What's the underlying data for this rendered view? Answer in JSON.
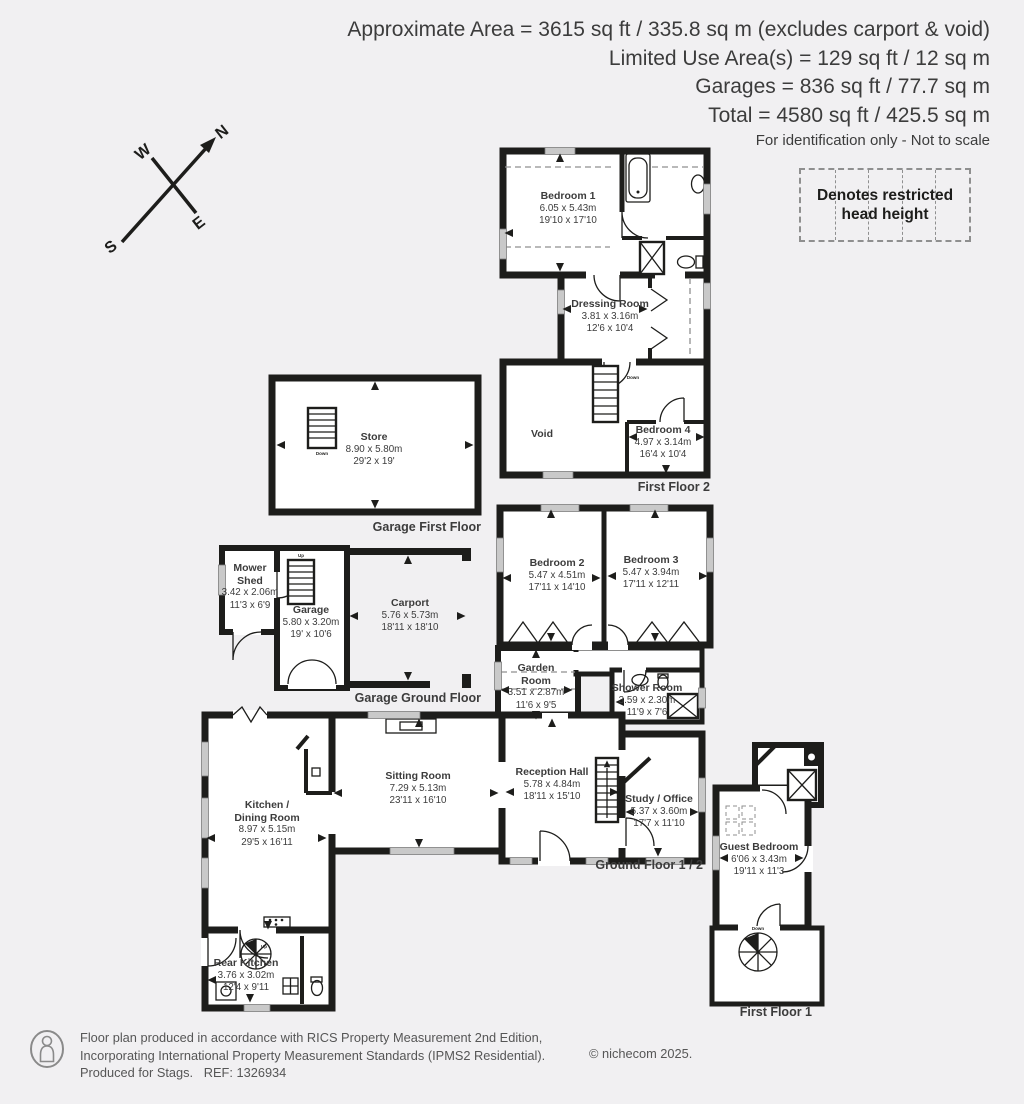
{
  "header": {
    "line1": "Approximate Area = 3615 sq ft / 335.8 sq m (excludes carport & void)",
    "line2": "Limited Use Area(s) = 129 sq ft / 12 sq m",
    "line3": "Garages = 836 sq ft / 77.7 sq m",
    "line4": "Total = 4580 sq ft / 425.5 sq m",
    "disclaimer": "For identification only - Not to scale"
  },
  "legend": {
    "restricted_head_height": "Denotes restricted head height"
  },
  "compass": {
    "n": "N",
    "e": "E",
    "s": "S",
    "w": "W"
  },
  "stairs": {
    "up": "Up",
    "down": "Down"
  },
  "floor_labels": {
    "first_floor_2": "First Floor 2",
    "garage_first_floor": "Garage First Floor",
    "garage_ground_floor": "Garage Ground Floor",
    "ground_floor_1_2": "Ground Floor 1 / 2",
    "first_floor_1": "First Floor 1"
  },
  "rooms": {
    "bedroom1": {
      "name": "Bedroom 1",
      "metric": "6.05 x 5.43m",
      "imperial": "19'10 x 17'10"
    },
    "dressing": {
      "name": "Dressing Room",
      "metric": "3.81 x 3.16m",
      "imperial": "12'6 x 10'4"
    },
    "void": {
      "name": "Void"
    },
    "bedroom4": {
      "name": "Bedroom 4",
      "metric": "4.97 x 3.14m",
      "imperial": "16'4 x 10'4"
    },
    "store": {
      "name": "Store",
      "metric": "8.90 x 5.80m",
      "imperial": "29'2 x 19'"
    },
    "mower": {
      "name": "Mower Shed",
      "metric": "3.42 x 2.06m",
      "imperial": "11'3 x 6'9"
    },
    "garage": {
      "name": "Garage",
      "metric": "5.80 x 3.20m",
      "imperial": "19' x 10'6"
    },
    "carport": {
      "name": "Carport",
      "metric": "5.76 x 5.73m",
      "imperial": "18'11 x 18'10"
    },
    "bedroom2": {
      "name": "Bedroom 2",
      "metric": "5.47 x 4.51m",
      "imperial": "17'11 x 14'10"
    },
    "bedroom3": {
      "name": "Bedroom 3",
      "metric": "5.47 x 3.94m",
      "imperial": "17'11 x 12'11"
    },
    "garden": {
      "name": "Garden Room",
      "metric": "3.51 x 2.87m",
      "imperial": "11'6 x 9'5"
    },
    "shower": {
      "name": "Shower Room",
      "metric": "3.59 x 2.30m",
      "imperial": "11'9 x 7'6"
    },
    "sitting": {
      "name": "Sitting Room",
      "metric": "7.29 x 5.13m",
      "imperial": "23'11 x 16'10"
    },
    "reception": {
      "name": "Reception Hall",
      "metric": "5.78 x 4.84m",
      "imperial": "18'11 x 15'10"
    },
    "study": {
      "name": "Study / Office",
      "metric": "5.37 x 3.60m",
      "imperial": "17'7 x 11'10"
    },
    "kitchen": {
      "name": "Kitchen / Dining Room",
      "metric": "8.97 x 5.15m",
      "imperial": "29'5 x 16'11"
    },
    "rear": {
      "name": "Rear Kitchen",
      "metric": "3.76 x 3.02m",
      "imperial": "12'4 x 9'11"
    },
    "guest": {
      "name": "Guest Bedroom",
      "metric": "6'06 x 3.43m",
      "imperial": "19'11 x 11'3"
    }
  },
  "footer": {
    "line1": "Floor plan produced in accordance with RICS Property Measurement 2nd Edition,",
    "line2": "Incorporating International Property Measurement Standards (IPMS2 Residential).",
    "line3": "Produced for Stags.   REF: 1326934",
    "copyright": "© nichecom 2025."
  },
  "colors": {
    "wall": "#1d1d1b",
    "window": "#c9c9c9",
    "dashed": "#8f8f8f",
    "text": "#3c3c3c",
    "background": "#f1f0f2"
  }
}
